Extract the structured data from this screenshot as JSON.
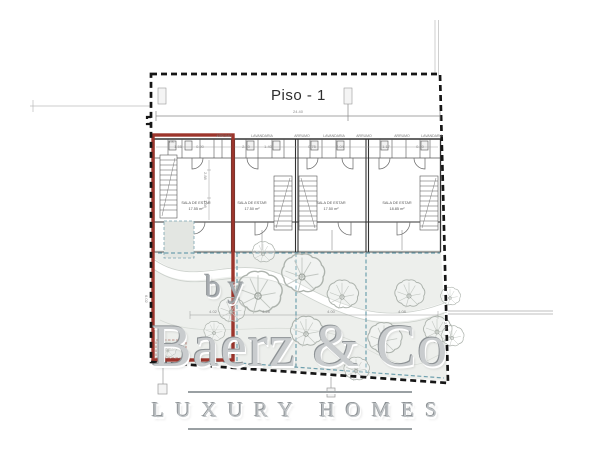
{
  "plan": {
    "title": "Piso - 1",
    "overall_width_dim": "24.40",
    "units": [
      {
        "room_label": "SALA DE ESTAR",
        "area": "17.55 m²"
      },
      {
        "room_label": "SALA DE ESTAR",
        "area": "17.50 m²"
      },
      {
        "room_label": "SALA DE ESTAR",
        "area": "17.50 m²"
      },
      {
        "room_label": "SALA DE ESTAR",
        "area": "18.85 m²"
      }
    ],
    "top_room_labels": [
      "I.S.",
      "ARRUMO",
      "LAVANDARIA",
      "ARRUMO",
      "LAVANDARIA",
      "ARRUMO",
      "ARRUMO",
      "LAVANDARIA"
    ],
    "strip_dims": [
      "1.55",
      "0.90",
      "2.10",
      "1.40",
      "0.75",
      "2.04",
      "1.17",
      "0.80"
    ],
    "garden_dims": [
      "4.02",
      "4.28",
      "4.00",
      "4.08"
    ],
    "side_dims": {
      "left_height": "6.02",
      "right_depth": "2.75",
      "u1_a": "2.88",
      "u1_b": "1.98"
    },
    "garden_label": "JARDIM PVC",
    "colors": {
      "lot_outline_red": "#9c352c",
      "patio_dashed_blue": "#6fa0ae",
      "boundary_black": "#161616",
      "garden_fill": "#edefec",
      "watermark_gray": "#c9ccce"
    }
  },
  "watermark": {
    "by": "by",
    "brand": "Baerz & Co",
    "tagline": "LUXURY HOMES"
  }
}
